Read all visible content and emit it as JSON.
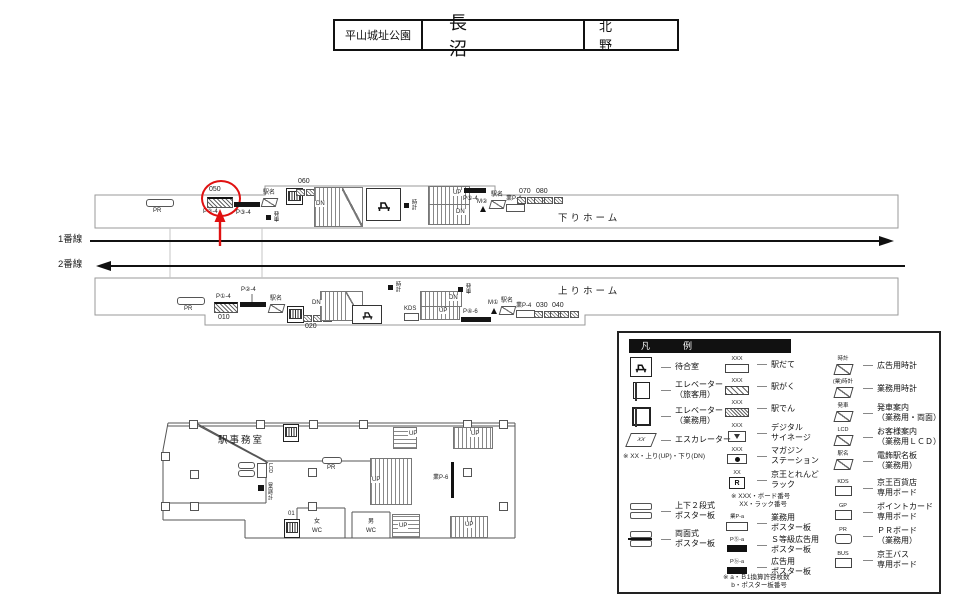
{
  "header": {
    "prev_station": "平山城址公園",
    "station": "長　　沼",
    "next_station": "北　野"
  },
  "tracks": {
    "line1": "1番線",
    "line2": "2番線"
  },
  "map": {
    "down_platform": "下りホーム",
    "up_platform": "上りホーム",
    "pr": "PR",
    "up": "UP",
    "dn": "DN",
    "kds": "KDS",
    "n010": "010",
    "n020": "020",
    "n030": "030",
    "n040": "040",
    "n050": "050",
    "n060": "060",
    "n070": "070",
    "n080": "080",
    "p1": "P①-4",
    "p2": "P②-4",
    "p3": "P③-4",
    "p4": "P④-6",
    "p5": "P⑤-4",
    "m1": "M①",
    "m2": "M②",
    "gyo_p4": "業P-4",
    "ekimei": "駅名",
    "tokei": "時計",
    "hassha": "発車"
  },
  "floorplan": {
    "office": "駅事務室",
    "pr": "PR",
    "lcd": "LCD",
    "gyo_tokei": "(業)時計",
    "n01": "01",
    "womens_wc": "女\nWC",
    "mens_wc": "男\nWC",
    "gyo_p6": "業P-6",
    "up": "UP"
  },
  "legend": {
    "title": "凡　例",
    "facilities": [
      {
        "name": "waiting-room",
        "icon_text": "",
        "label": "待合室"
      },
      {
        "name": "elevator-passenger",
        "icon_text": "",
        "label": "エレベーター\n（旅客用）"
      },
      {
        "name": "elevator-service",
        "icon_text": "",
        "label": "エレベーター\n（業務用）"
      },
      {
        "name": "escalator",
        "icon_text": "XX",
        "label": "エスカレーター"
      }
    ],
    "escalator_note": "※ XX・上り(UP)・下り(DN)",
    "posters_left": [
      {
        "name": "two-tier-poster",
        "label": "上下２段式\nポスター板"
      },
      {
        "name": "double-sided-poster",
        "label": "両面式\nポスター板"
      }
    ],
    "boards": [
      {
        "name": "ekidate",
        "icon_text": "XXX",
        "label": "駅だて"
      },
      {
        "name": "ekigaku",
        "icon_text": "XXX",
        "label": "駅がく"
      },
      {
        "name": "ekiden",
        "icon_text": "XXX",
        "label": "駅でん"
      },
      {
        "name": "digital-signage",
        "icon_text": "XXX",
        "label": "デジタル\nサイネージ"
      },
      {
        "name": "magazine-station",
        "icon_text": "XXX",
        "label": "マガジン\nステーション"
      },
      {
        "name": "keio-trend-rack",
        "icon_text": "XX",
        "icon_letter": "R",
        "label": "京王とれんど\nラック"
      }
    ],
    "board_note": "※ XXX・ボード番号\n　 XX・ラック番号",
    "poster_types": [
      {
        "name": "service-poster",
        "icon_text": "業P-a",
        "label": "業務用\nポスター板"
      },
      {
        "name": "s-grade-poster",
        "icon_text": "PⓈ-a",
        "label": "Ｓ等級広告用\nポスター板"
      },
      {
        "name": "ad-poster",
        "icon_text": "Pⓑ-a",
        "label": "広告用\nポスター板"
      }
    ],
    "poster_note": "※ a・Ｂ1換算許容枚数\n　 b・ポスター板番号",
    "signs": [
      {
        "name": "ad-clock",
        "icon_text": "時計",
        "label": "広告用時計"
      },
      {
        "name": "service-clock",
        "icon_text": "(業)時計",
        "label": "業務用時計"
      },
      {
        "name": "departure-info",
        "icon_text": "発車",
        "label": "発車案内\n（業務用・両面）"
      },
      {
        "name": "customer-lcd",
        "icon_text": "LCD",
        "label": "お客様案内\n（業務用ＬＣＤ）"
      },
      {
        "name": "station-name-sign",
        "icon_text": "駅名",
        "label": "電飾駅名板\n（業務用）"
      }
    ],
    "dedicated_boards": [
      {
        "name": "kds-board",
        "icon_text": "KDS",
        "label": "京王百貨店\n専用ボード"
      },
      {
        "name": "gp-board",
        "icon_text": "GP",
        "label": "ポイントカード\n専用ボード"
      },
      {
        "name": "pr-board",
        "icon_text": "PR",
        "label": "ＰＲボード\n（業務用）"
      },
      {
        "name": "bus-board",
        "icon_text": "BUS",
        "label": "京王バス\n専用ボード"
      }
    ]
  },
  "colors": {
    "accent_red": "#e01111",
    "outline_gray": "#9a9a9a",
    "ink": "#111111"
  }
}
